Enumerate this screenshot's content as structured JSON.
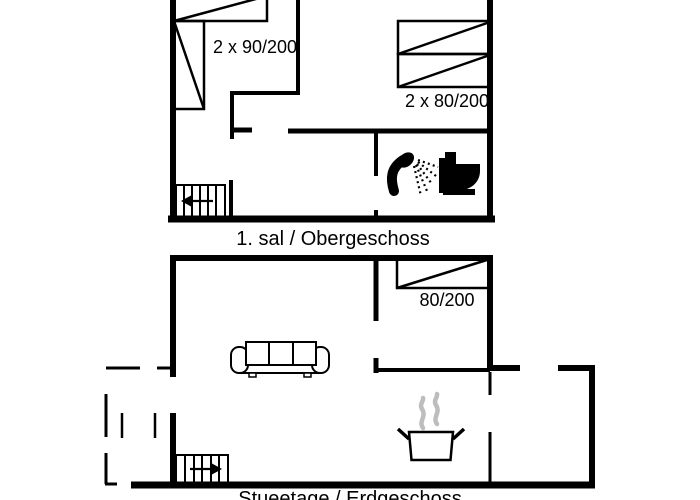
{
  "plan": {
    "colors": {
      "wall": "#000000",
      "background": "#ffffff",
      "steam": "#bdbdbd"
    },
    "upper_floor": {
      "floor_label": "1. sal / Obergeschoss",
      "beds": [
        {
          "label": "2 x 90/200"
        },
        {
          "label": "2 x 80/200"
        }
      ],
      "icons": [
        "double-bed-icon",
        "twin-bed-icon",
        "shower-icon",
        "toilet-icon",
        "staircase-arrow-left-icon"
      ]
    },
    "lower_floor": {
      "floor_label": "Stueetage / Erdgeschoss",
      "beds": [
        {
          "label": "80/200"
        }
      ],
      "icons": [
        "single-bed-icon",
        "sofa-icon",
        "cooking-pot-steam-icon",
        "staircase-arrow-right-icon",
        "dashed-terrace-outline"
      ]
    }
  }
}
